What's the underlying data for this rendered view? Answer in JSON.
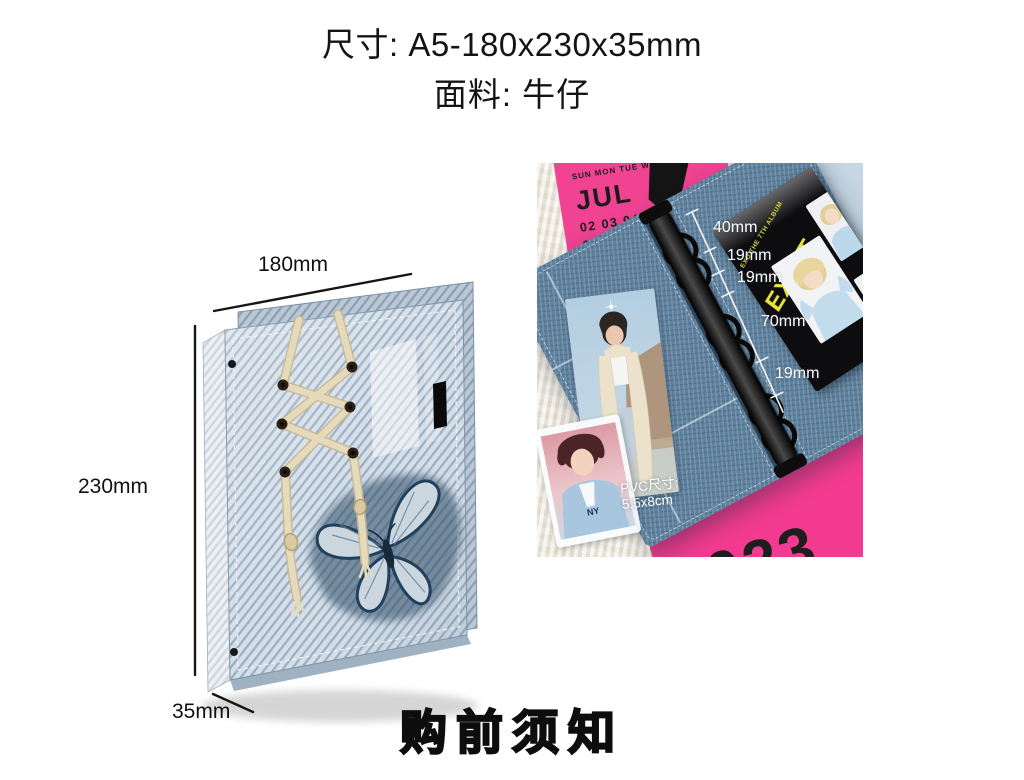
{
  "header": {
    "size_line": "尺寸: A5-180x230x35mm",
    "fabric_line": "面料: 牛仔"
  },
  "diagram": {
    "width_label": "180mm",
    "height_label": "230mm",
    "depth_label": "35mm"
  },
  "photo": {
    "calendar_jul": {
      "weekdays": "SUN MON TUE WED",
      "day_right": "01",
      "month": "JUL",
      "week_row1": "02 03 04 05 0",
      "week_row2": "09 10 1"
    },
    "album": {
      "series_label": "EXO THE 7TH ALBUM",
      "title": "EXIST"
    },
    "ring_measurements": [
      "40mm",
      "19mm",
      "19mm",
      "70mm",
      "19mm"
    ],
    "pvc_note": {
      "label": "PVC尺寸:",
      "value": "5.5x8cm"
    },
    "pvc_card_logo": "NY",
    "calendar_2023": {
      "partial_word": "ing",
      "month_num": "12",
      "year": "2023"
    }
  },
  "footer": {
    "notice": "购前须知"
  },
  "colors": {
    "hot_pink": "#f23b90",
    "denim_cover": "#b6c5d5",
    "denim_inner": "#5e819e",
    "album_yellow": "#e8e437"
  }
}
